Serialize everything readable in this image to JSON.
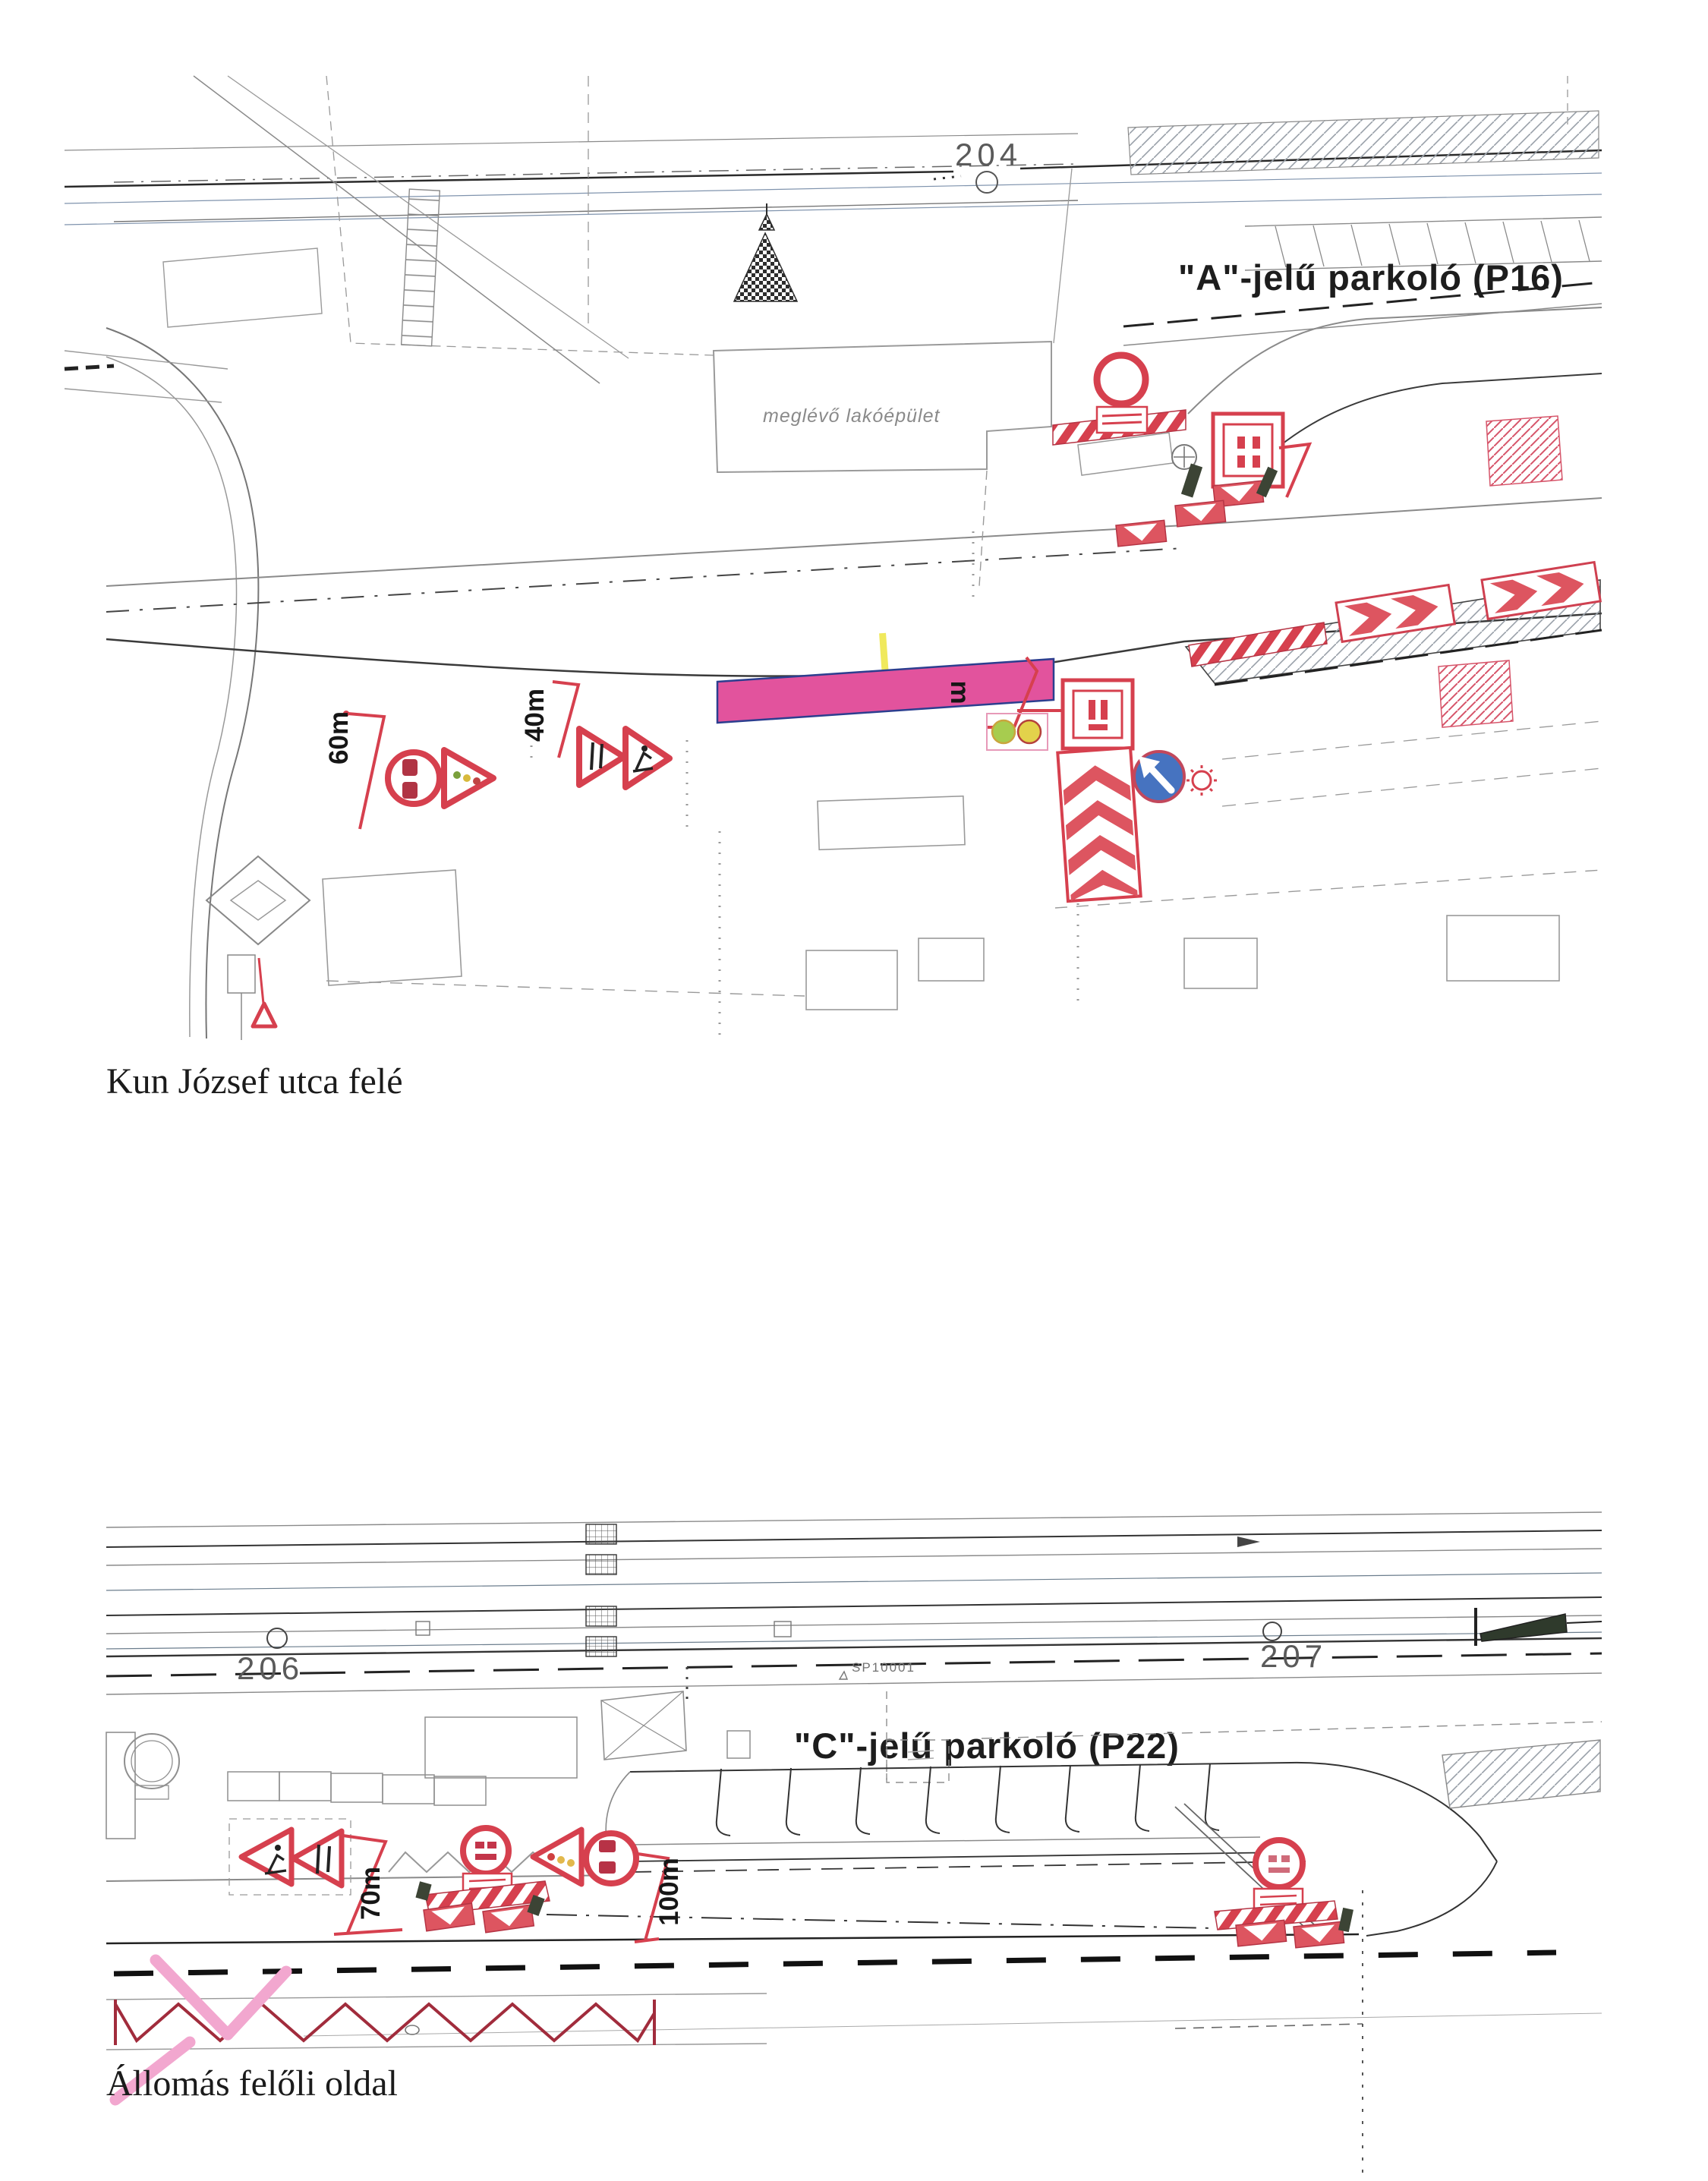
{
  "top_plan": {
    "title": "\"A\"-jelű parkoló (P16)",
    "survey_point": "204",
    "building_label": "meglévő lakóépület",
    "distances": {
      "d60": "60m",
      "d40": "40m"
    },
    "dimension_suffix": "m",
    "caption": "Kun József utca felé"
  },
  "bottom_plan": {
    "title": "\"C\"-jelű parkoló (P22)",
    "survey_point_left": "206",
    "survey_point_right": "207",
    "marker_label": "SP10001",
    "distances": {
      "d70": "70m",
      "d100": "100m"
    },
    "caption": "Állomás felőli oldal"
  },
  "colors": {
    "sign_red": "#d6404e",
    "sign_dark_red": "#b03444",
    "work_zone_pink": "#e2539d",
    "chevron_red": "#dd5560",
    "sign_blue": "#4673c0",
    "signal_green": "#a7cc4f",
    "signal_yellow": "#e3d24b",
    "highlight_pink": "#f2a7cf",
    "line_dark": "#2a2a2a",
    "line_gray": "#8a8a8a"
  }
}
